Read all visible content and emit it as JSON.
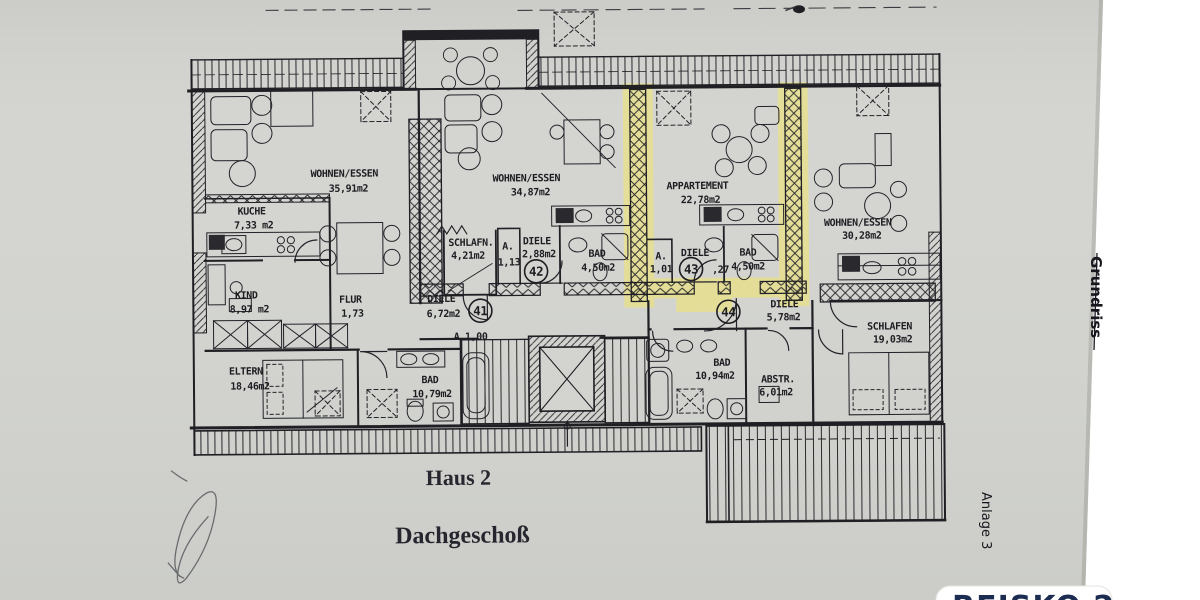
{
  "page": {
    "bg": "#ffffff",
    "paper_color": "#d3d4d0",
    "paper_edge_color": "#b9bab4",
    "ink_color": "#1f1f24",
    "highlight_color": "#e7e08b",
    "scribble_color": "#5a5a60",
    "logo_color": "#1d2d52"
  },
  "titles": {
    "building": "Haus 2",
    "floor": "Dachgeschoß",
    "side_label": "Grundriss",
    "attachment_label": "Anlage 3",
    "watermark": "REISKO 2"
  },
  "rooms": [
    {
      "unit": "41",
      "label": "WOHNEN/ESSEN",
      "area": "35,91m2"
    },
    {
      "unit": "41",
      "label": "KUCHE",
      "area": "7,33 m2"
    },
    {
      "unit": "41",
      "label": "KIND",
      "area": "8,97 m2"
    },
    {
      "unit": "41",
      "label": "FLUR",
      "area": "1,73"
    },
    {
      "unit": "41",
      "label": "ELTERN",
      "area": "18,46m2"
    },
    {
      "unit": "41",
      "label": "BAD",
      "area": "10,79m2"
    },
    {
      "unit": "41",
      "label": "DIELE",
      "area": "6,72m2"
    },
    {
      "unit": "41",
      "label": "A.1,00",
      "area": ""
    },
    {
      "unit": "42",
      "label": "WOHNEN/ESSEN",
      "area": "34,87m2"
    },
    {
      "unit": "42",
      "label": "SCHLAFN.",
      "area": "4,21m2"
    },
    {
      "unit": "42",
      "label": "A.",
      "area": "1,13"
    },
    {
      "unit": "42",
      "label": "DIELE",
      "area": "2,88m2"
    },
    {
      "unit": "42",
      "label": "BAD",
      "area": "4,50m2"
    },
    {
      "unit": "43",
      "label": "APPARTEMENT",
      "area": "22,78m2"
    },
    {
      "unit": "43",
      "label": "A.",
      "area": "1,01"
    },
    {
      "unit": "43",
      "label": "DIELE",
      "area": ",27"
    },
    {
      "unit": "43",
      "label": "BAD",
      "area": "4,50m2"
    },
    {
      "unit": "44",
      "label": "WOHNEN/ESSEN",
      "area": "30,28m2"
    },
    {
      "unit": "44",
      "label": "DIELE",
      "area": "5,78m2"
    },
    {
      "unit": "44",
      "label": "SCHLAFEN",
      "area": "19,03m2"
    },
    {
      "unit": "44",
      "label": "BAD",
      "area": "10,94m2"
    },
    {
      "unit": "44",
      "label": "ABSTR.",
      "area": "6,01m2"
    }
  ],
  "units": [
    {
      "number": "41"
    },
    {
      "number": "42"
    },
    {
      "number": "43"
    },
    {
      "number": "44"
    }
  ]
}
